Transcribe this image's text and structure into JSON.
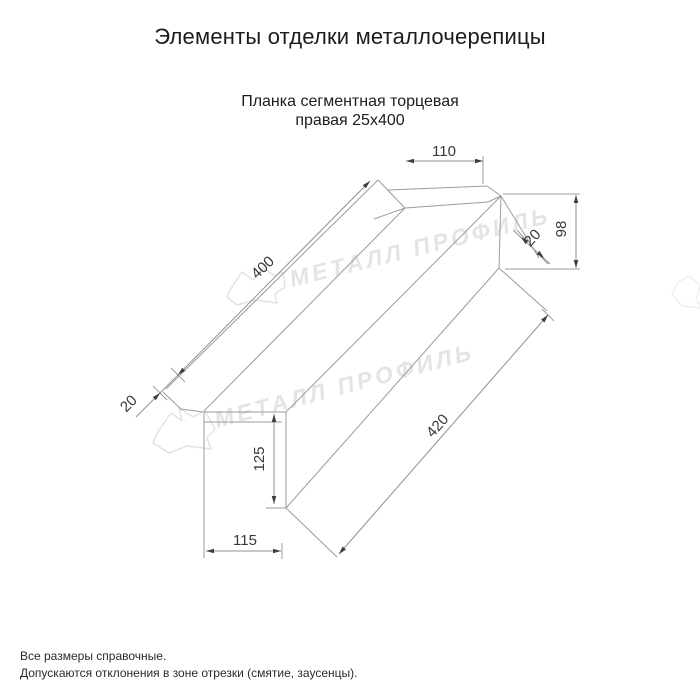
{
  "page": {
    "title": "Элементы отделки металлочерепицы",
    "subtitle_line1": "Планка сегментная торцевая",
    "subtitle_line2": "правая 25х400"
  },
  "notes": {
    "line1": "Все размеры справочные.",
    "line2": "Допускаются отклонения в зоне отрезки (смятие, заусенцы)."
  },
  "watermark": {
    "text": "МЕТАЛЛ ПРОФИЛЬ",
    "color": "#e4e4e4"
  },
  "dimensions": {
    "top_width": {
      "value": "110",
      "unit": "mm"
    },
    "end_height": {
      "value": "98",
      "unit": "mm"
    },
    "end_hem": {
      "value": "20",
      "unit": "mm"
    },
    "flange_length": {
      "value": "400",
      "unit": "mm"
    },
    "bottom_length": {
      "value": "420",
      "unit": "mm"
    },
    "left_hem": {
      "value": "20",
      "unit": "mm"
    },
    "left_height": {
      "value": "125",
      "unit": "mm"
    },
    "left_width": {
      "value": "115",
      "unit": "mm"
    }
  },
  "colors": {
    "line": "#9c9c9c",
    "dimension_text": "#383838",
    "arrow": "#3f3f3f",
    "text": "#1c1c1c",
    "watermark": "#e4e4e4",
    "background": "#ffffff"
  }
}
